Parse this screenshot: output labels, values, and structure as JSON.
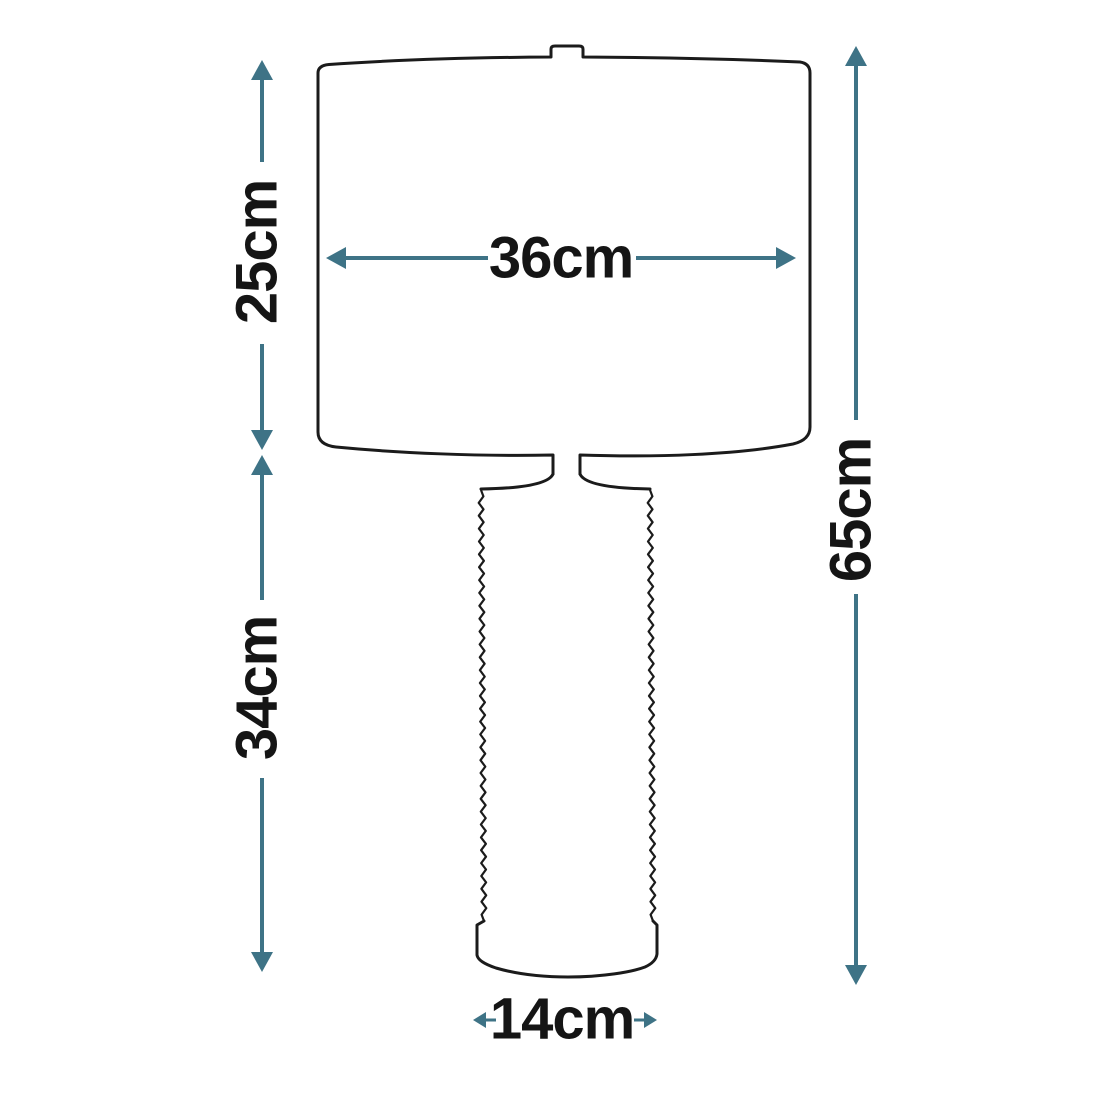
{
  "diagram": {
    "kind": "table-lamp-dimension-diagram",
    "colors": {
      "dimension_arrows": "#3e7386",
      "outline": "#1b1b1b",
      "label_text": "#151515",
      "background": "#ffffff"
    },
    "dimensions": {
      "shade_height": {
        "label": "25cm"
      },
      "shade_width": {
        "label": "36cm"
      },
      "base_height": {
        "label": "34cm"
      },
      "total_height": {
        "label": "65cm"
      },
      "base_width": {
        "label": "14cm"
      }
    }
  }
}
